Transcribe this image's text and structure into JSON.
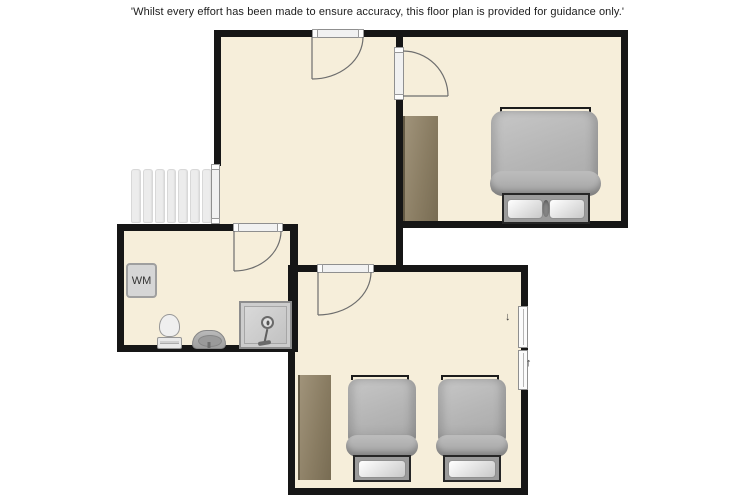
{
  "disclaimer": "'Whilst every effort has been made to ensure accuracy, this floor plan is provided for guidance only.'",
  "bathroom": {
    "washing_machine_label": "WM"
  },
  "windows": {
    "open_direction_down": "↓",
    "open_direction_up": "↑"
  },
  "colors": {
    "background": "#ffffff",
    "wall": "#161616",
    "floor": "#f6eeda",
    "wardrobe": "#8a7d63",
    "bed_duvet": "#b7b7b7",
    "bed_base": "#9b9b9b",
    "pillow": "#ededed",
    "stairs": "#ececec",
    "fixture": "#cdcdcd",
    "door_arc": "#6e6e6e"
  }
}
